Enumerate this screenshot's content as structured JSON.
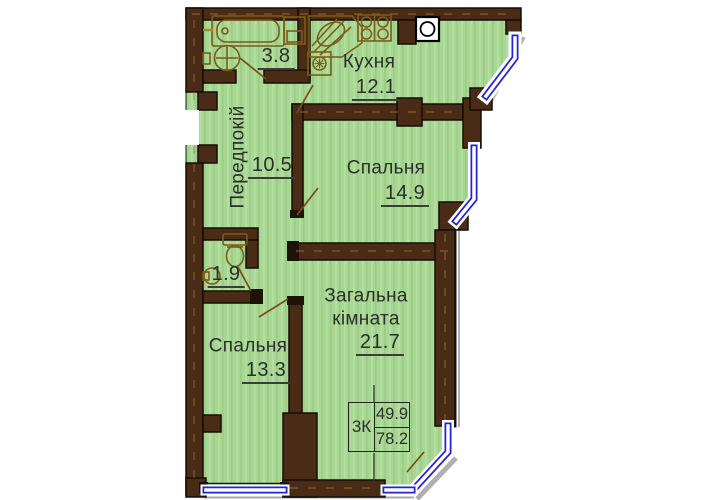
{
  "plan": {
    "summary": {
      "code": "3К",
      "living_area": "49.9",
      "total_area": "78.2"
    },
    "rooms": {
      "bathroom": {
        "area": "3.8"
      },
      "kitchen": {
        "name": "Кухня",
        "area": "12.1"
      },
      "hallway": {
        "name": "Передпокій",
        "area": "10.5"
      },
      "bedroom1": {
        "name": "Спальня",
        "area": "14.9"
      },
      "wc": {
        "area": "1.9"
      },
      "bedroom2": {
        "name": "Спальня",
        "area": "13.3"
      },
      "living": {
        "name_line1": "Загальна",
        "name_line2": "кімната",
        "area": "21.7"
      }
    },
    "colors": {
      "floor_green": "#a7d793",
      "wall_brown": "#4a2b15",
      "window_blue": "#2222dd",
      "fixture_olive": "#7d5c15",
      "text": "#2d2d2d"
    }
  }
}
